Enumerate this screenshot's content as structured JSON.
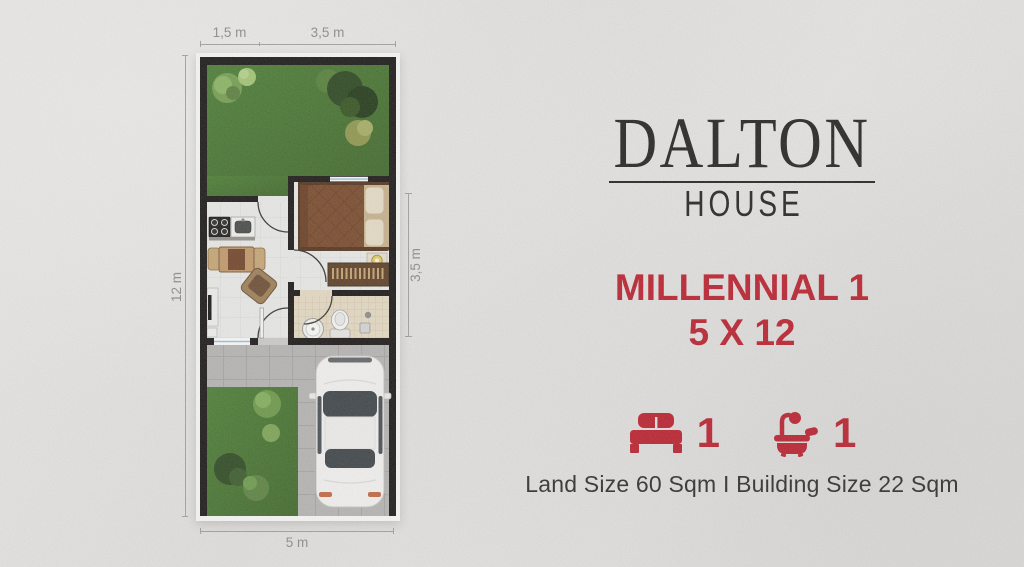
{
  "branding": {
    "name": "DALTON",
    "subtitle": "HOUSE"
  },
  "unit": {
    "name": "MILLENNIAL 1",
    "size": "5 X 12"
  },
  "features": {
    "bedrooms": {
      "icon": "bed-icon",
      "count": "1"
    },
    "bathrooms": {
      "icon": "bath-icon",
      "count": "1"
    }
  },
  "details": {
    "land_building": "Land Size 60 Sqm I Building Size 22 Sqm"
  },
  "floor_plan": {
    "dimensions": {
      "top_left": "1,5 m",
      "top_right": "3,5 m",
      "left": "12 m",
      "right": "3,5 m",
      "bottom": "5 m"
    }
  },
  "colors": {
    "accent_red": "#bd202e",
    "logo_dark": "#252122",
    "text_dark": "#2f2d2c",
    "dimension_gray": "#8d8d8b",
    "background": "#e7e6e4",
    "grass_green": "#4a7c33",
    "wall_black": "#1a1716"
  }
}
